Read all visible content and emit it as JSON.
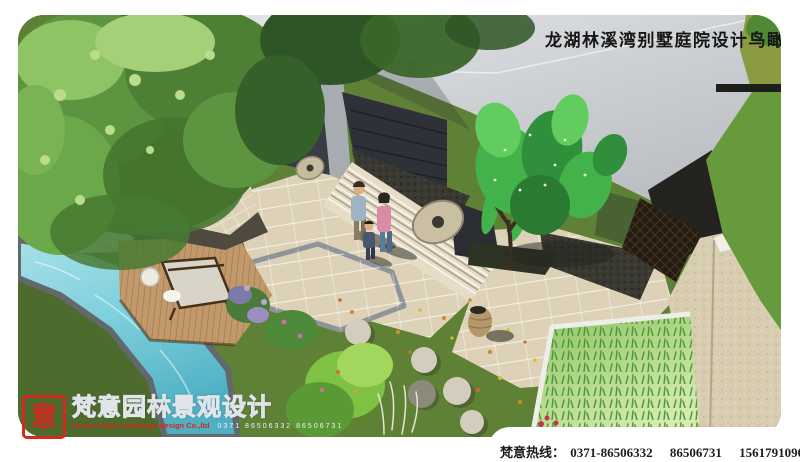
{
  "title": {
    "text": "龙湖林溪湾别墅庭院设计鸟瞰图"
  },
  "logo": {
    "seal_char": "意",
    "brand_cn": "梵意园林景观设计",
    "company_en": "Henan Fanyi Landscape design Co.,ltd",
    "phone_digits": "0371 86506332 86506731"
  },
  "footer": {
    "hotline_label": "梵意热线：",
    "phones": [
      "0371-86506332",
      "86506731",
      "15617910900（孙）"
    ]
  },
  "colors": {
    "paper": "#ffffff",
    "ink": "#161616",
    "footer_ink": "#1d1d1d",
    "logo_red": "#d5281e",
    "logo_outline": "#dfe5e8",
    "roof_light": "#e3e5e7",
    "roof_dark": "#b7bbbf",
    "roof_fold": "#a9adb2",
    "wall_dark": "#383d45",
    "door_dark": "#2e3238",
    "slope_dark": "#24231f",
    "gravel": "#3a3931",
    "lattice": "#241c12",
    "stone_wall": "#d8cdb1",
    "paving": "#ddd2b7",
    "paving_edge": "#8f949a",
    "step_light": "#e7ddc7",
    "water_hi": "#a8e0e8",
    "water_mid": "#7ccfdc",
    "water_deep": "#4fb0c4",
    "water_dark": "#16393a",
    "water_edge": "#63686b",
    "lawn": "#5f8136",
    "lawn_dark": "#4c6b2c",
    "lawn_olive": "#8a9b42",
    "lawn_bright": "#679a3d",
    "canopy_hi": "#a5d077",
    "canopy_light": "#8fc465",
    "canopy_mid": "#5d9440",
    "canopy_dark": "#3e6b2d",
    "canopy_deep": "#2f5526",
    "tree_bright": "#44b24a",
    "deck": "#c2996b",
    "bed_light": "#d6eab2",
    "bed_green": "#8cc462",
    "stone": "#d3cdbd",
    "jar": "#b5976b",
    "skin": "#d9af87",
    "shirt_blue": "#9fb3c2",
    "shirt_pink": "#d98ca4",
    "jeans": "#5e7a9a",
    "shadow": "#20241f"
  }
}
